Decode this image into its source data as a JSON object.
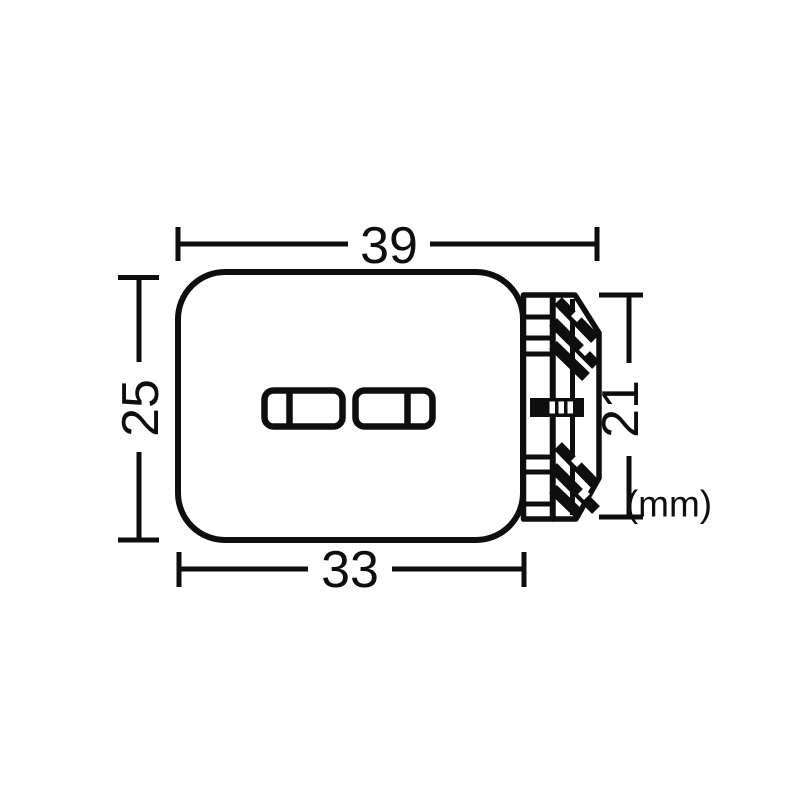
{
  "colors": {
    "line": "#0e0e0e",
    "background": "#ffffff"
  },
  "labels": {
    "top_width": "39",
    "bottom_width": "33",
    "left_height": "25",
    "right_height": "21",
    "unit": "(mm)"
  }
}
